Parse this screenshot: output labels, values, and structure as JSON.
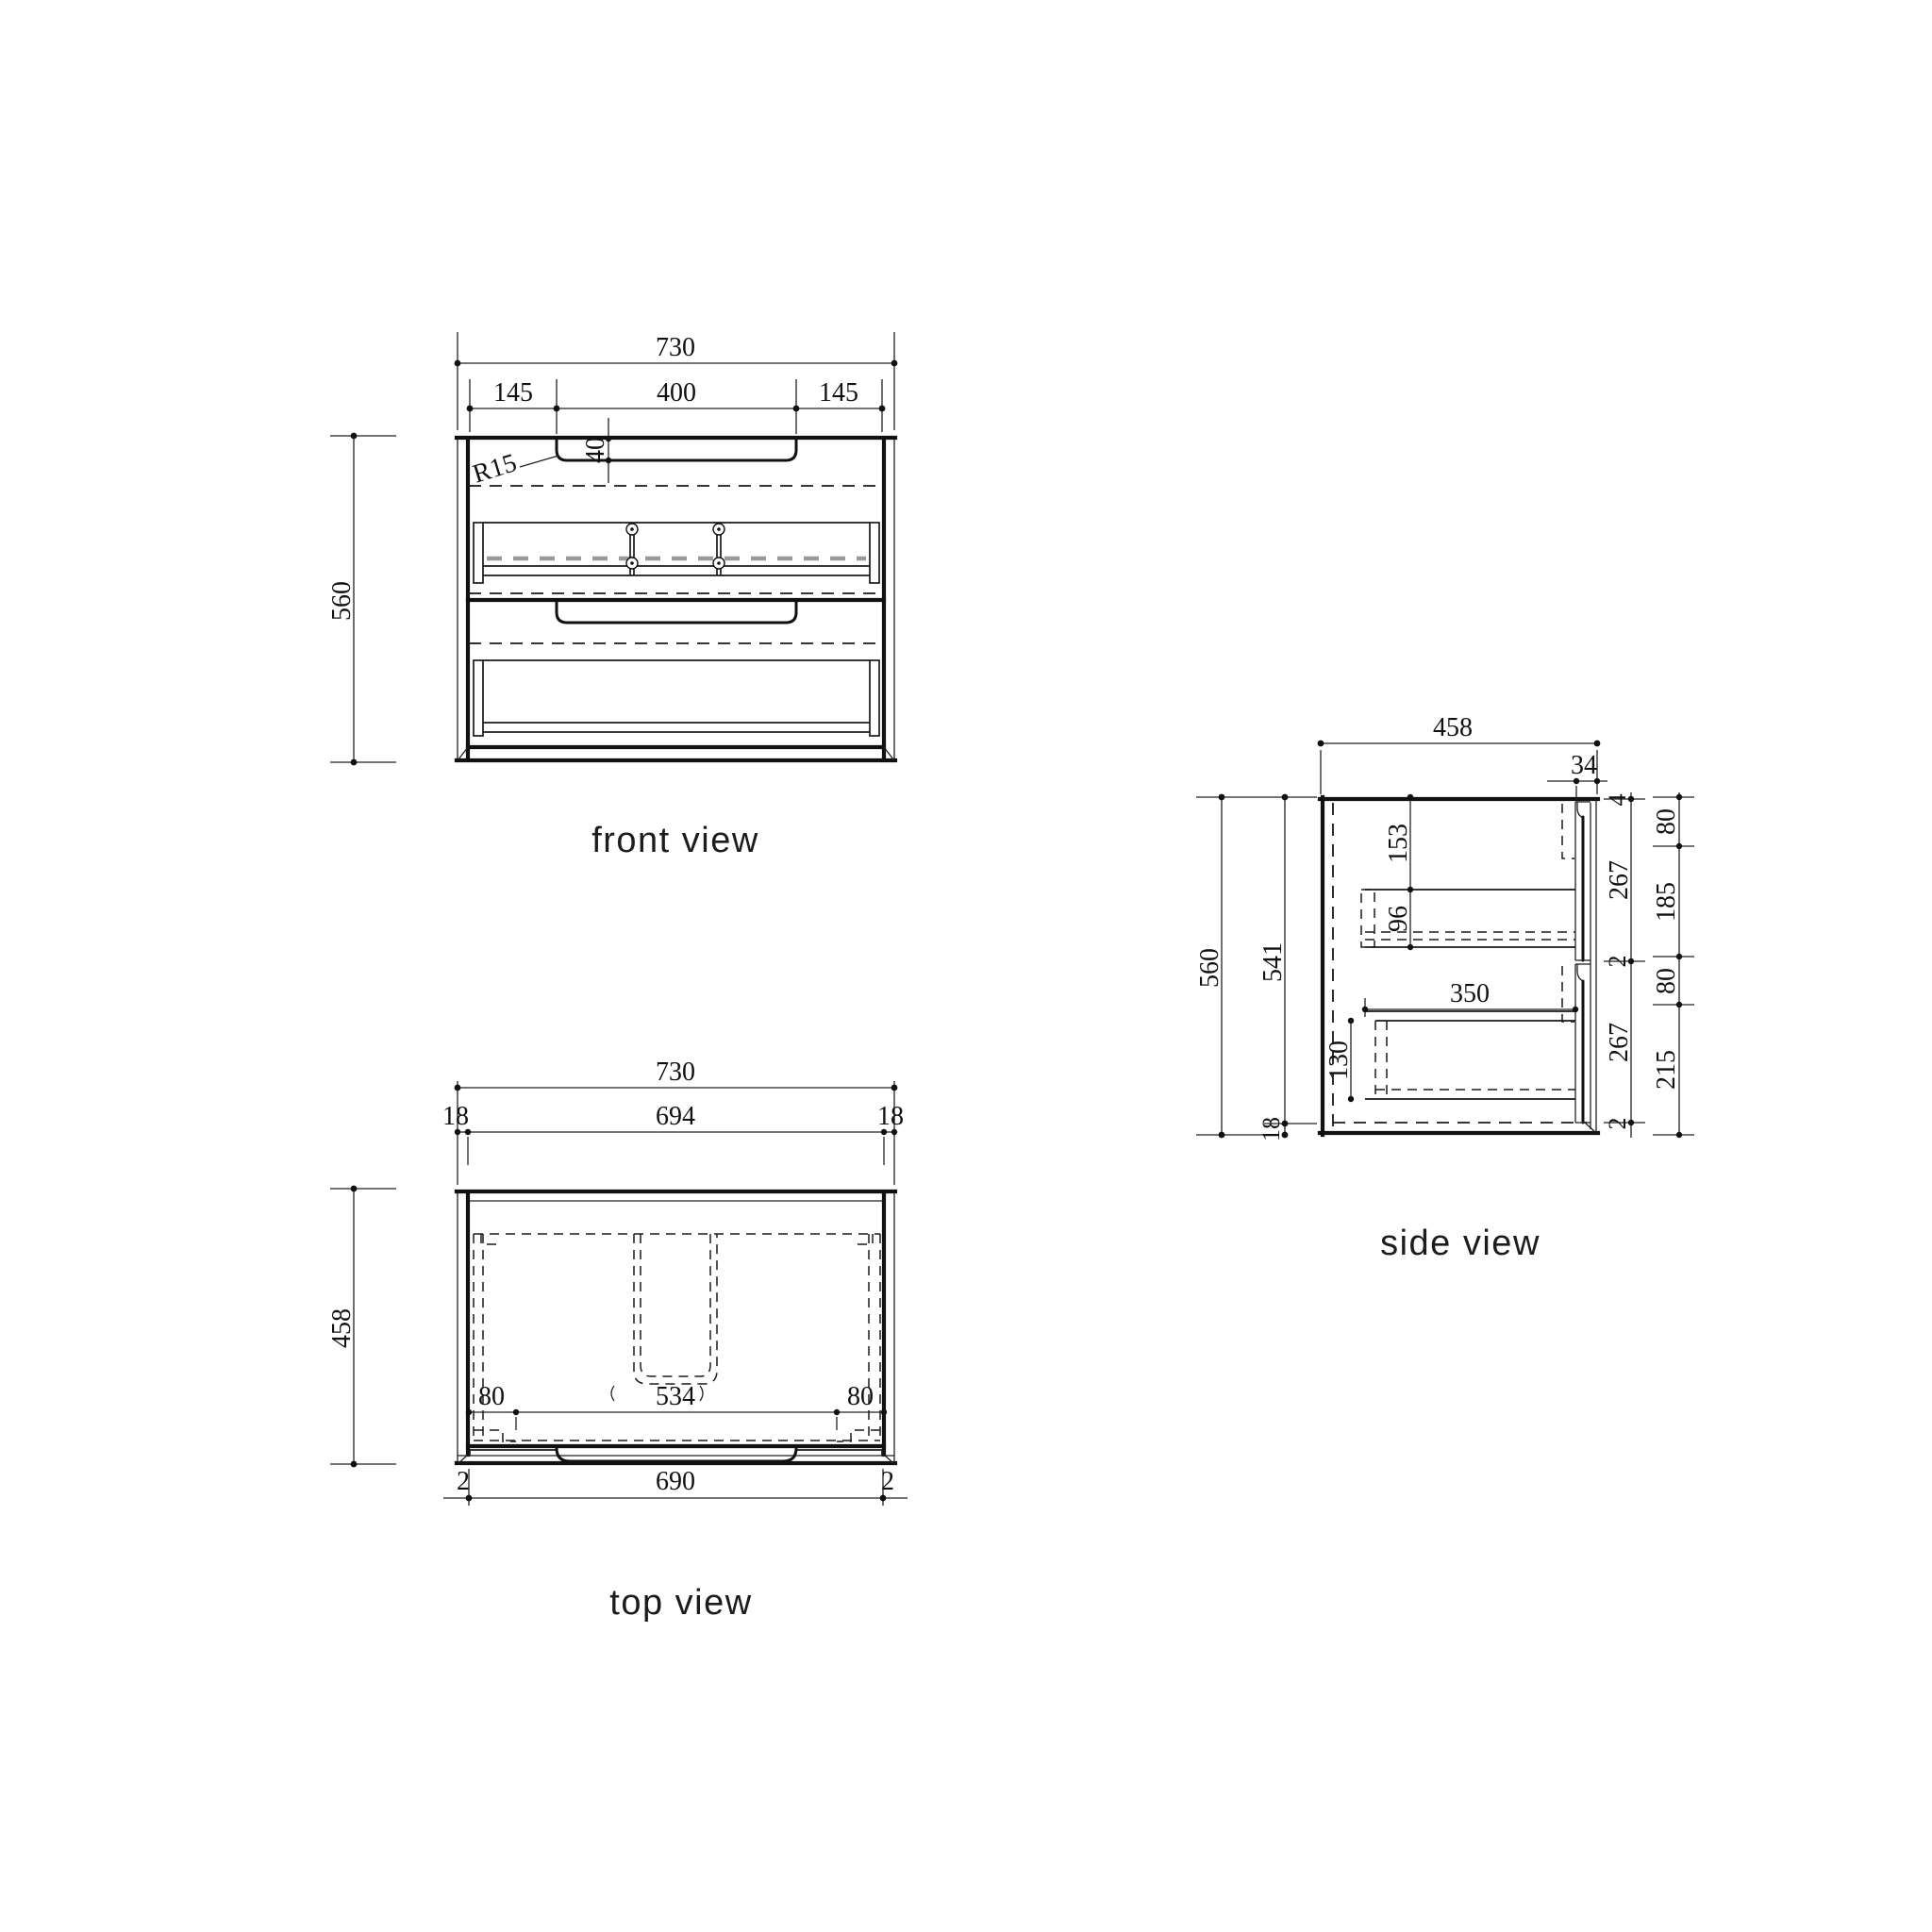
{
  "views": {
    "front": {
      "title": "front view",
      "dims": {
        "width": "730",
        "seg_left": "145",
        "seg_center": "400",
        "seg_right": "145",
        "recess_depth": "40",
        "recess_radius": "R15",
        "height": "560"
      }
    },
    "top": {
      "title": "top view",
      "dims": {
        "width": "730",
        "edge_left": "18",
        "inner_width": "694",
        "edge_right": "18",
        "depth": "458",
        "rail_left": "80",
        "center_clear": "534",
        "rail_right": "80",
        "gap_left": "2",
        "front_width": "690",
        "gap_right": "2"
      }
    },
    "side": {
      "title": "side view",
      "dims": {
        "depth": "458",
        "overhang": "34",
        "height": "560",
        "inner_height": "541",
        "bottom_panel": "18",
        "rail_top_offset": "153",
        "rail_height": "96",
        "drawer_depth": "350",
        "drawer_box_height": "130",
        "front_top_gap": "4",
        "front1_height": "267",
        "front_gap": "2",
        "front2_height": "267",
        "front_bottom_gap": "2",
        "grip1_height": "80",
        "between_grips": "185",
        "grip2_height": "80",
        "grip2_to_bottom": "215"
      }
    }
  }
}
